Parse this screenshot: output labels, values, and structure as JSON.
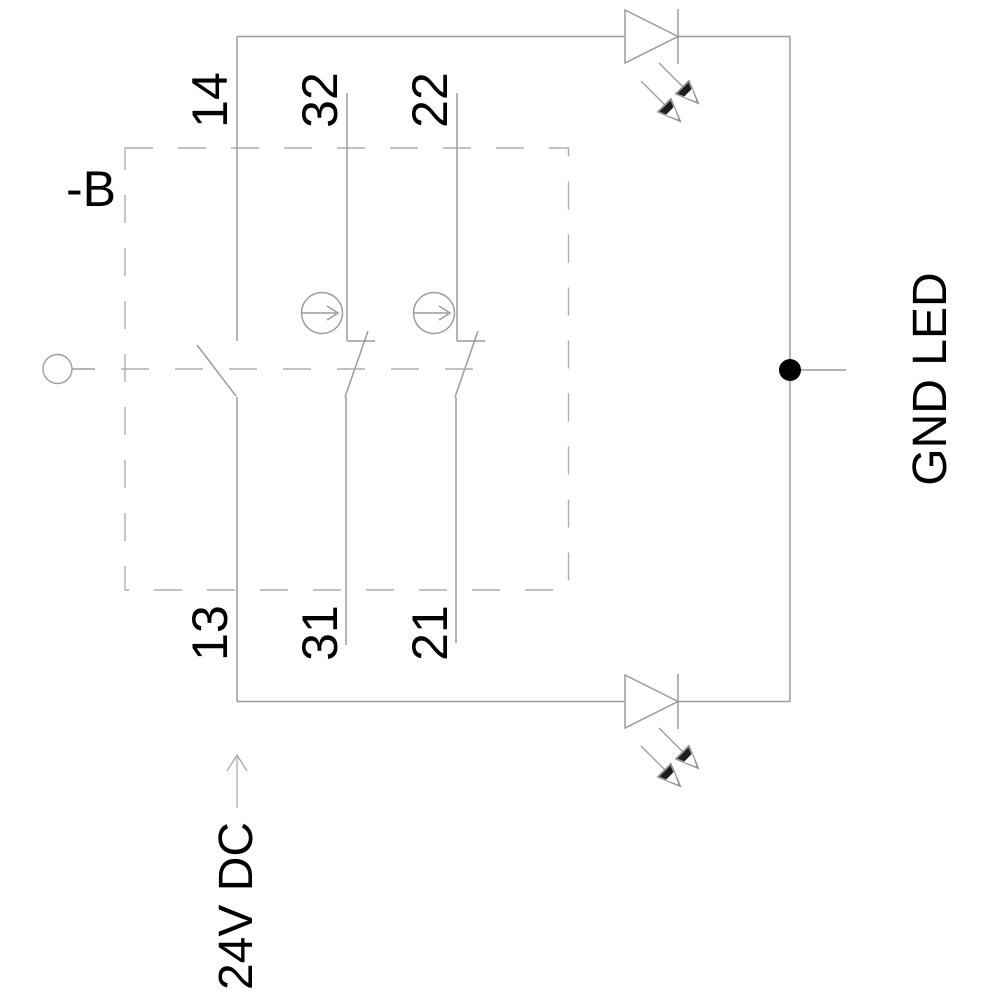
{
  "diagram": {
    "kind": "pushbutton-contact-block-schematic",
    "device_ref": "-B",
    "terminal_labels": {
      "no_contact": {
        "top": "14",
        "bottom": "13"
      },
      "nc_contact_1": {
        "top": "32",
        "bottom": "31"
      },
      "nc_contact_2": {
        "top": "22",
        "bottom": "21"
      }
    },
    "annotations": {
      "supply": "24V DC",
      "ground": "GND LED"
    },
    "colors": {
      "wire": "#9c9c9c",
      "dash": "#aeaeae",
      "text": "#000000",
      "junction": "#000000",
      "arrowhead": "#1c1c1c"
    }
  }
}
